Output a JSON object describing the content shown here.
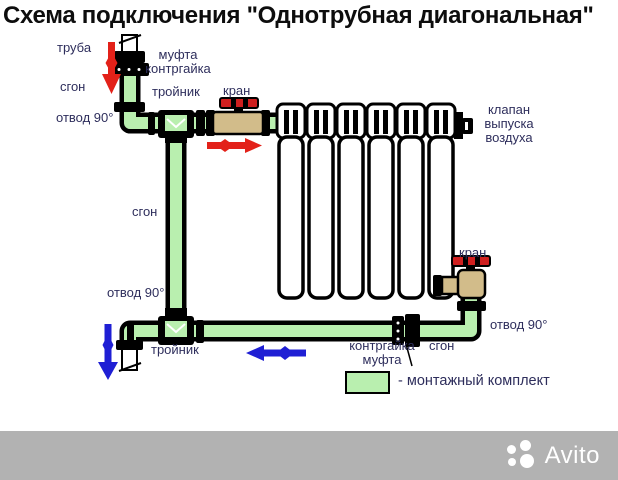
{
  "title": "Схема подключения \"Однотрубная диагональная\"",
  "diagram": {
    "labels": {
      "truba_top": "труба",
      "mufta_kontrgayka_top": "муфта\nконтргайка",
      "sgon_top_left": "сгон",
      "troynik_top": "тройник",
      "kran_top": "кран",
      "otvod90_top_left": "отвод 90°",
      "klapan_vypuska_vozdukha": "клапан\nвыпуска\nвоздуха",
      "sgon_middle": "сгон",
      "otvod90_bottom_left": "отвод 90°",
      "kran_bottom_right": "кран",
      "otvod90_bottom_right": "отвод 90°",
      "troynik_bottom": "тройник",
      "kontrgayka_mufta_bottom": "контргайка\nмуфта",
      "sgon_bottom_right": "сгон"
    },
    "colors": {
      "pipe_fill": "#b9efaf",
      "pipe_outline": "#000000",
      "valve_body": "#d2bc8a",
      "valve_handle": "#cf1f1f",
      "supply_arrow": "#e32119",
      "return_arrow": "#1f1fd4",
      "label_text": "#2e2e5c"
    }
  },
  "legend": {
    "swatch_color": "#b9efaf",
    "text": "- монтажный комплект"
  },
  "watermark": {
    "brand": "Avito"
  }
}
